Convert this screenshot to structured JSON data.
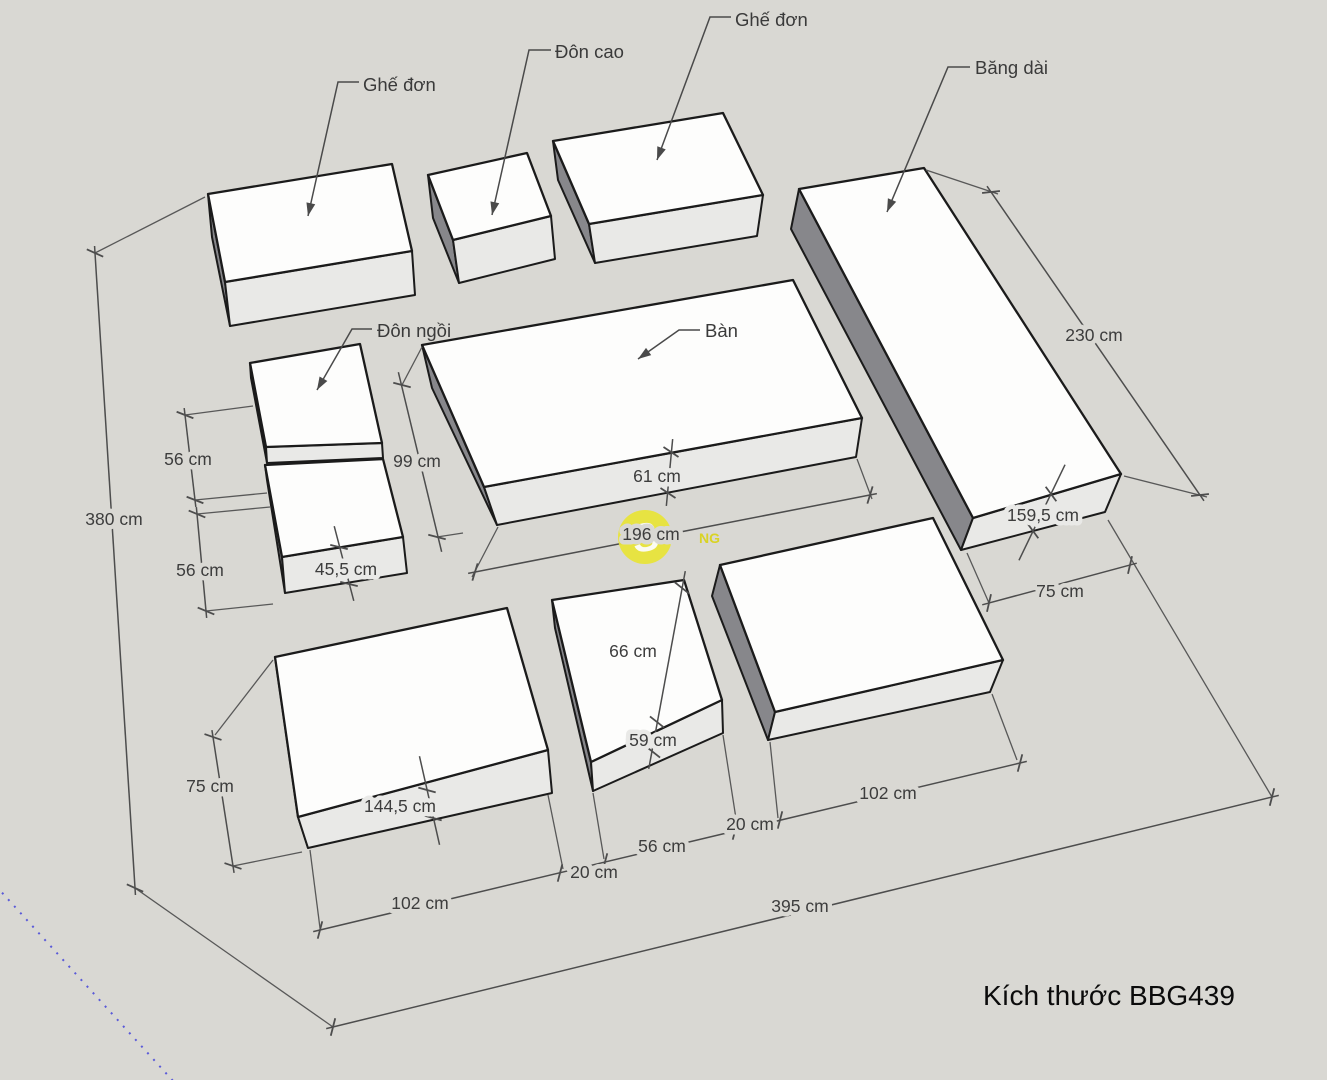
{
  "title": "Kích thước BBG439",
  "watermark": {
    "initial": "S",
    "fragment": "NG"
  },
  "item_labels": {
    "ghe_don_1": "Ghế đơn",
    "don_cao": "Đôn cao",
    "ghe_don_2": "Ghế đơn",
    "bang_dai": "Băng dài",
    "don_ngoi": "Đôn ngồi",
    "ban": "Bàn"
  },
  "dimensions": {
    "d380": "380 cm",
    "d56a": "56 cm",
    "d56b": "56 cm",
    "d455": "45,5 cm",
    "d99": "99 cm",
    "d61": "61 cm",
    "d196": "196 cm",
    "d230": "230 cm",
    "d1595": "159,5 cm",
    "d75r": "75 cm",
    "d66": "66 cm",
    "d59": "59 cm",
    "d75l": "75 cm",
    "d1445": "144,5 cm",
    "d102a": "102 cm",
    "d20a": "20 cm",
    "d56c": "56 cm",
    "d20b": "20 cm",
    "d102b": "102 cm",
    "d395": "395 cm"
  },
  "colors": {
    "background": "#d9d8d3",
    "box_top": "#fdfdfc",
    "box_front": "#e9e9e7",
    "box_side_dark": "#87878b",
    "edge": "#1b1b1b",
    "dimension": "#4d4d4d",
    "watermark_yellow": "#e8e435",
    "axis_blue": "#5a5ad8"
  }
}
